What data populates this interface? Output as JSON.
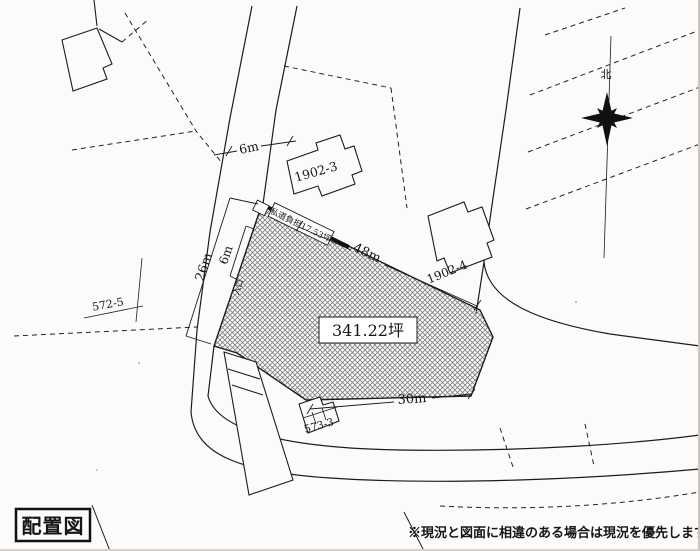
{
  "drawing": {
    "title": "配置図",
    "disclaimer": "※現況と図面に相違のある場合は現況を優先します。",
    "north": "北",
    "plot": {
      "area": "341.22坪",
      "road_burden": "私道負担17.53坪"
    },
    "dims": {
      "road_width": "6m",
      "frontage": "26m",
      "entrance_width": "6m",
      "entrance": "入口",
      "north_edge": "48m",
      "south_edge": "30m"
    },
    "lots": {
      "l1902_3": "1902-3",
      "l1902_4": "1902-4",
      "l572_5": "572-5",
      "l573_3": "573-3"
    },
    "colors": {
      "ink": "#1c1c1c",
      "paper": "#fcfbf9",
      "hatch": "#7d7d7d"
    }
  }
}
